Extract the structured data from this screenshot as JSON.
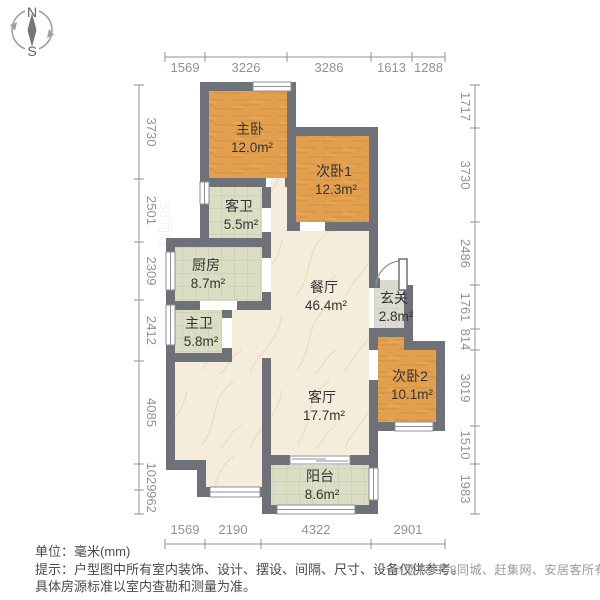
{
  "compass": {
    "north": "N",
    "south": "S"
  },
  "dimensions": {
    "top": [
      "1569",
      "3226",
      "3286",
      "1613",
      "1288"
    ],
    "bottom": [
      "1569",
      "2190",
      "4322",
      "2901"
    ],
    "left": [
      "3730",
      "2501",
      "2309",
      "2412",
      "4085",
      "1029",
      "962"
    ],
    "right": [
      "1717",
      "3730",
      "2486",
      "1761",
      "814",
      "3019",
      "1510",
      "1983"
    ]
  },
  "rooms": [
    {
      "id": "zhuwo",
      "name": "主卧",
      "area": "12.0m²"
    },
    {
      "id": "ciwo1",
      "name": "次卧1",
      "area": "12.3m²"
    },
    {
      "id": "kewei",
      "name": "客卫",
      "area": "5.5m²"
    },
    {
      "id": "chufang",
      "name": "厨房",
      "area": "8.7m²"
    },
    {
      "id": "zhuwei",
      "name": "主卫",
      "area": "5.8m²"
    },
    {
      "id": "canting",
      "name": "餐厅",
      "area": "46.4m²"
    },
    {
      "id": "xuanguan",
      "name": "玄关",
      "area": "2.8m²"
    },
    {
      "id": "ciwo2",
      "name": "次卧2",
      "area": "10.1m²"
    },
    {
      "id": "keting",
      "name": "客厅",
      "area": "17.7m²"
    },
    {
      "id": "yangtai",
      "name": "阳台",
      "area": "8.6m²"
    }
  ],
  "footer": {
    "unit": "单位：毫米(mm)",
    "tip_line1": "提示：户型图中所有室内装饰、设计、摆设、间隔、尺寸、设备仅供参考。",
    "tip_line2": "具体房源标准以室内查勘和测量为准。",
    "copyright": "© 版权归58同城、赶集网、安居客所有"
  },
  "watermark": "58同城",
  "colors": {
    "wall": "#6e7178",
    "bedroom": "#e2a04e",
    "bedroom_grain": "#cd8a3a",
    "tile": "#dbdec4",
    "tile_line": "#c6cba8",
    "hall": "#f5ecdb",
    "hall_vein": "#e3d2b4",
    "foyer": "#dbdbd2",
    "foyer_line": "#c9c9be",
    "dim": "#8e9297",
    "label": "#333333",
    "window_frame": "#8b8f96",
    "threshold": "#d9d9d0"
  }
}
